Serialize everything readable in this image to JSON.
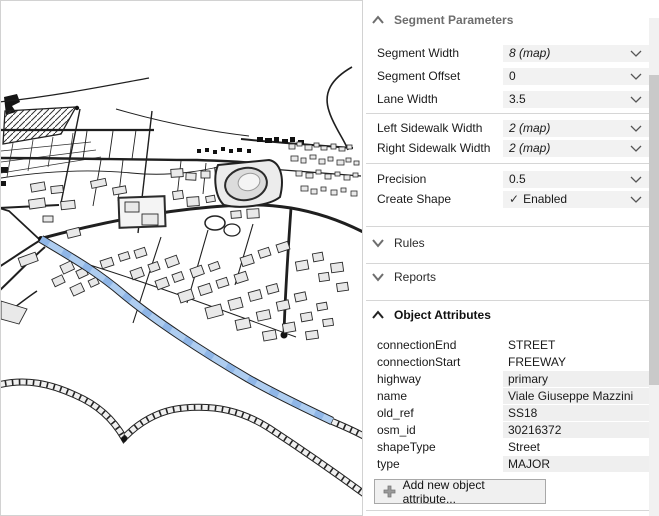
{
  "inspector": {
    "segment_parameters": {
      "title": "Segment Parameters",
      "fields": [
        {
          "label": "Segment Width",
          "value": "8 (map)"
        },
        {
          "label": "Segment Offset",
          "value": "0"
        },
        {
          "label": "Lane Width",
          "value": "3.5"
        },
        {
          "label": "Left Sidewalk Width",
          "value": "2 (map)"
        },
        {
          "label": "Right Sidewalk Width",
          "value": "2 (map)"
        },
        {
          "label": "Precision",
          "value": "0.5"
        },
        {
          "label": "Create Shape",
          "value": "Enabled"
        }
      ]
    },
    "rules": {
      "title": "Rules"
    },
    "reports": {
      "title": "Reports"
    },
    "object_attributes": {
      "title": "Object Attributes",
      "rows": [
        {
          "key": "connectionEnd",
          "value": "STREET"
        },
        {
          "key": "connectionStart",
          "value": "FREEWAY"
        },
        {
          "key": "highway",
          "value": "primary"
        },
        {
          "key": "name",
          "value": "Viale Giuseppe Mazzini"
        },
        {
          "key": "old_ref",
          "value": "SS18"
        },
        {
          "key": "osm_id",
          "value": "30216372"
        },
        {
          "key": "shapeType",
          "value": "Street"
        },
        {
          "key": "type",
          "value": "MAJOR"
        }
      ],
      "add_button": "Add new object attribute..."
    }
  },
  "icons": {
    "check": "✓"
  },
  "map": {
    "colors": {
      "selected_road_fill": "#aecdf0",
      "selected_road_edge": "#6fa0dd",
      "linework": "#1f1f1f",
      "building_fill": "#e9e9e9"
    }
  }
}
